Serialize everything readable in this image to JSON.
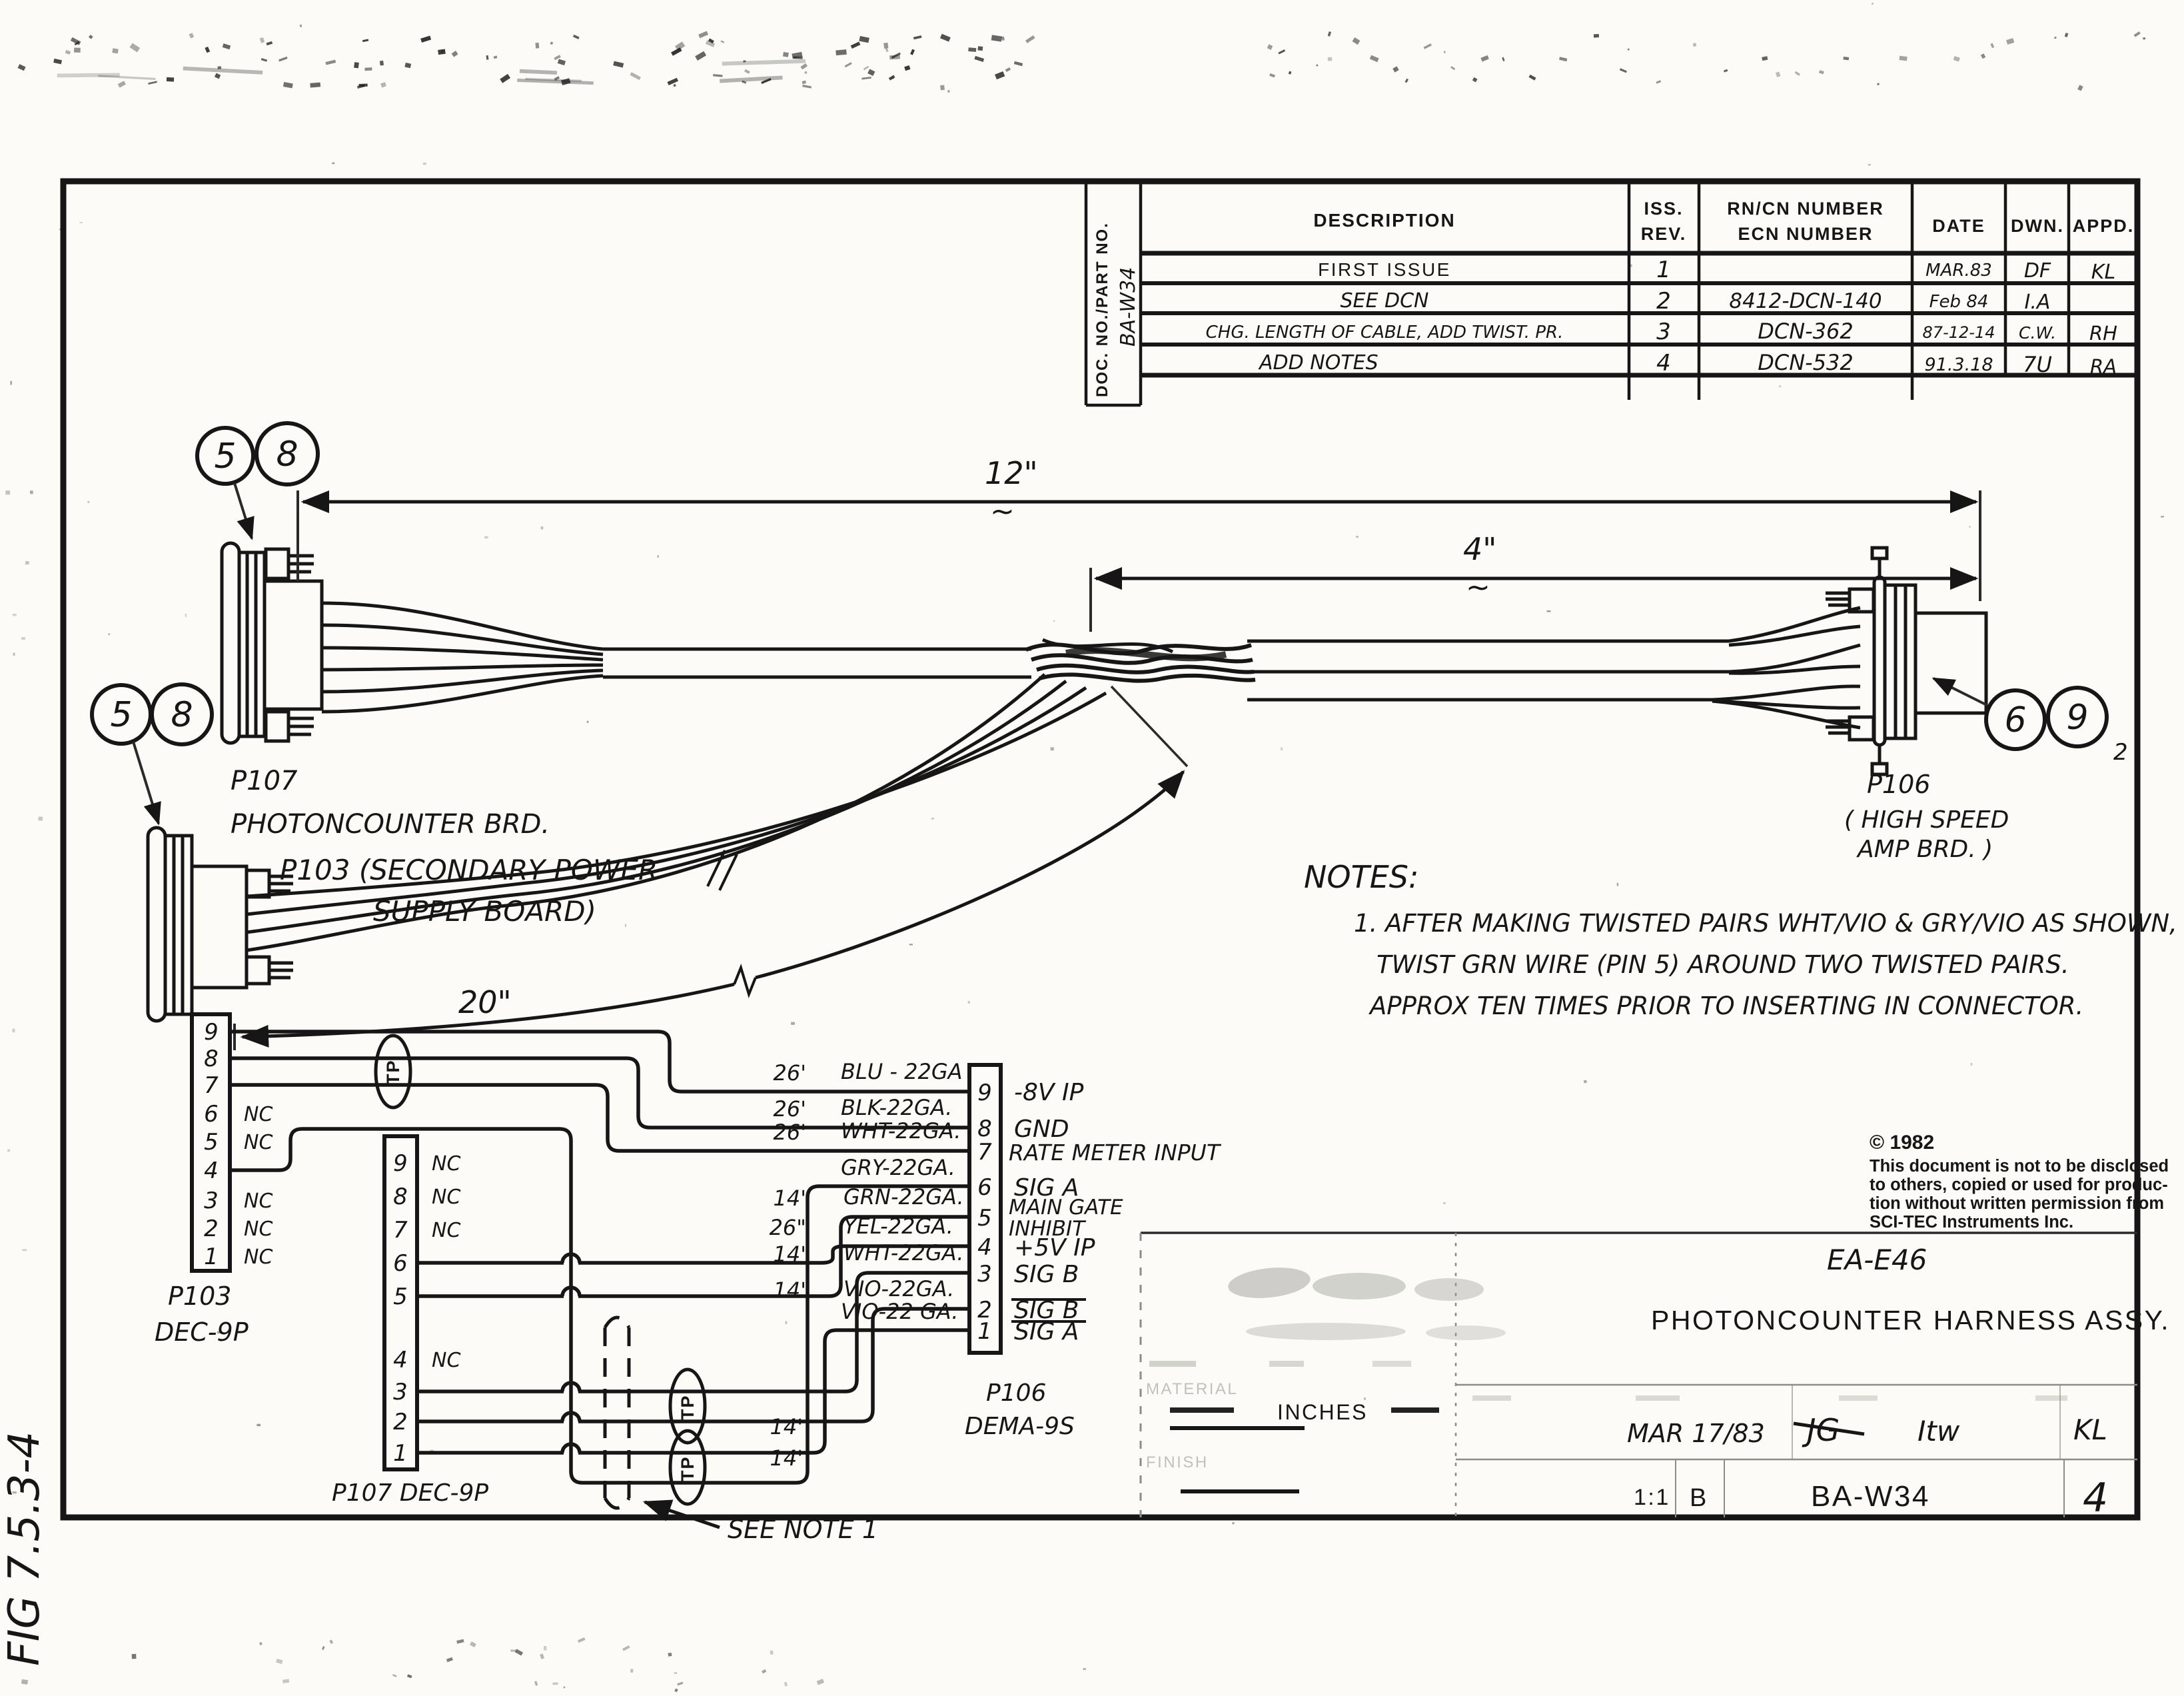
{
  "page": {
    "fig_label": "FIG 7.5.3-4"
  },
  "rev_table": {
    "doc_no_label": "DOC. NO./PART NO.",
    "doc_no_value": "BA-W34",
    "col_description": "DESCRIPTION",
    "col_iss": "ISS.",
    "col_rev": "REV.",
    "col_rncn": "RN/CN NUMBER",
    "col_ecn": "ECN NUMBER",
    "col_date": "DATE",
    "col_dwn": "DWN.",
    "col_appd": "APPD.",
    "rows": [
      {
        "description": "FIRST ISSUE",
        "rev": "1",
        "number": "",
        "date": "MAR.83",
        "dwn": "DF",
        "appd": "KL"
      },
      {
        "description": "SEE DCN",
        "rev": "2",
        "number": "8412-DCN-140",
        "date": "Feb 84",
        "dwn": "I.A",
        "appd": ""
      },
      {
        "description": "CHG. LENGTH OF CABLE, ADD TWIST. PR.",
        "rev": "3",
        "number": "DCN-362",
        "date": "87-12-14",
        "dwn": "C.W.",
        "appd": "RH"
      },
      {
        "description": "ADD NOTES",
        "rev": "4",
        "number": "DCN-532",
        "date": "91.3.18",
        "dwn": "7U",
        "appd": "RA"
      }
    ]
  },
  "assembly": {
    "balloon_5": "5",
    "balloon_8": "8",
    "balloon_6": "6",
    "balloon_9": "9",
    "balloon_9_sub": "2",
    "dim_overall": "12\"",
    "dim_mid": "4\"",
    "dim_left": "20\"",
    "tilde": "~",
    "p107_name": "P107",
    "p107_desc": "PHOTONCOUNTER BRD.",
    "p103_desc_line1": "P103 (SECONDARY POWER",
    "p103_desc_line2": "SUPPLY BOARD)",
    "p106_name": "P106",
    "p106_desc_line1": "( HIGH SPEED",
    "p106_desc_line2": "AMP BRD. )"
  },
  "notes": {
    "heading": "NOTES:",
    "line1": "1. AFTER MAKING TWISTED PAIRS WHT/VIO & GRY/VIO AS SHOWN,",
    "line2": "TWIST GRN WIRE (PIN 5) AROUND TWO TWISTED PAIRS.",
    "line3": "APPROX TEN TIMES PRIOR TO INSERTING IN CONNECTOR."
  },
  "wiring": {
    "nc": "NC",
    "tp": "TP",
    "see_note": "SEE NOTE 1",
    "len_14_a": "14'",
    "len_14_b": "14'",
    "p103_label_line1": "P103",
    "p103_label_line2": "DEC-9P",
    "p107_label": "P107  DEC-9P",
    "p106_label_line1": "P106",
    "p106_label_line2": "DEMA-9S",
    "p103_pins": [
      "9",
      "8",
      "7",
      "6",
      "5",
      "4",
      "3",
      "2",
      "1"
    ],
    "p107_pins": [
      "9",
      "8",
      "7",
      "6",
      "5",
      "4",
      "3",
      "2",
      "1"
    ],
    "rows": [
      {
        "pin": "9",
        "len": "26'",
        "wire": "BLU - 22GA",
        "signal": "-8V IP"
      },
      {
        "pin": "8",
        "len": "26'",
        "wire": "BLK-22GA.",
        "signal": "GND"
      },
      {
        "pin": "7",
        "len": "26'",
        "wire": "WHT-22GA.",
        "signal": "RATE METER INPUT"
      },
      {
        "pin": "6",
        "len": "",
        "wire": "GRY-22GA.",
        "signal": "SIG A"
      },
      {
        "pin": "5",
        "len": "14'",
        "wire": "GRN-22GA.",
        "signal": "MAIN GATE",
        "signal2": "INHIBIT"
      },
      {
        "pin": "4",
        "len": "26\"",
        "wire": "YEL-22GA.",
        "signal": "+5V IP"
      },
      {
        "pin": "3",
        "len": "14'",
        "wire": "WHT-22GA.",
        "signal": "SIG B"
      },
      {
        "pin": "2",
        "len": "14'",
        "wire": "VIO-22GA.",
        "signal": "SIG B"
      },
      {
        "pin": "1",
        "len": "",
        "wire": "VIO-22 GA.",
        "signal": "SIG A"
      }
    ]
  },
  "copyright": {
    "year": "© 1982",
    "line1": "This document is not to be disclosed",
    "line2": "to others, copied or used for produc-",
    "line3": "tion without written permission from",
    "line4": "SCI-TEC Instruments Inc."
  },
  "title_block": {
    "ref_no": "EA-E46",
    "title": "PHOTONCOUNTER HARNESS ASSY.",
    "units": "INCHES",
    "material_label": "MATERIAL",
    "finish_label": "FINISH",
    "date": "MAR 17/83",
    "sig_drawn": "JG",
    "sig_checked": "Itw",
    "sig_approved": "KL",
    "scale": "1:1",
    "size": "B",
    "doc_no": "BA-W34",
    "sheet": "4"
  }
}
